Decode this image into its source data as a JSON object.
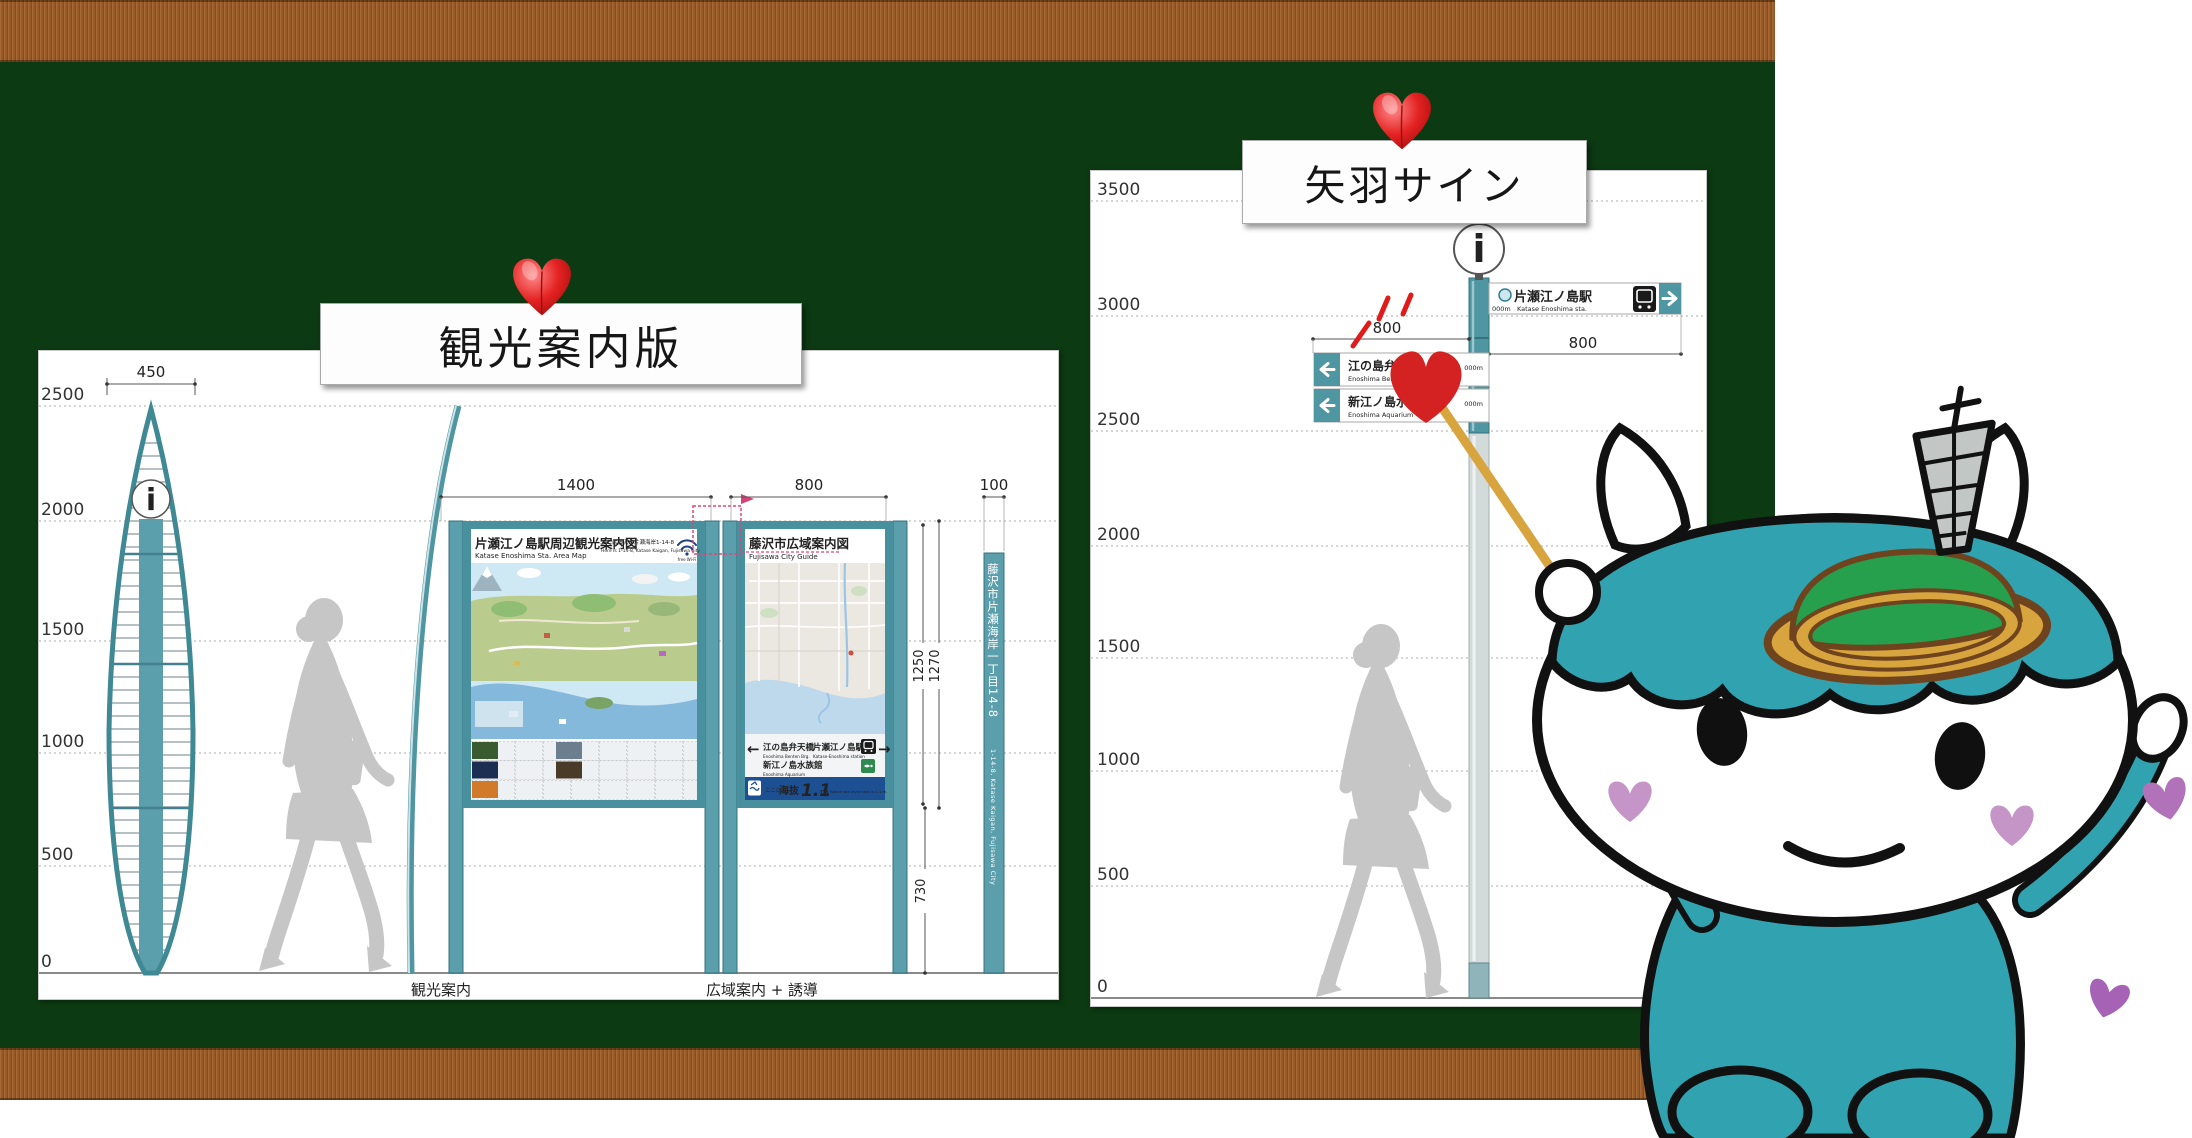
{
  "left": {
    "title": "観光案内版",
    "axis": [
      "2500",
      "2000",
      "1500",
      "1000",
      "500",
      "0"
    ],
    "dims": {
      "kiosk_w": "450",
      "main_w": "1400",
      "sub_w": "800",
      "pole_w": "100",
      "inner_h": "1250",
      "outer_h": "1270",
      "base_h": "730"
    },
    "kiosk_icon": "i",
    "main_board": {
      "title_jp": "片瀬江ノ島駅周辺観光案内図",
      "title_en": "Katase Enoshima Sta. Area Map",
      "addr_jp": "ここは藤沢市片瀬海岸1-14-8",
      "addr_en": "Here is 1-14-8, Katase Kaigan, Fujisawa City",
      "wifi": "free Wi-Fi"
    },
    "sub_board": {
      "title_jp": "藤沢市広域案内図",
      "title_en": "Fujisawa City Guide"
    },
    "guide": {
      "left_arrow": "←",
      "right_arrow": "→",
      "left_jp": "江の島弁天橋",
      "left_en": "Enoshima Benten Brg.",
      "right_jp": "片瀬江ノ島駅",
      "right_en": "Katase-Enoshima station",
      "aq_jp": "新江ノ島水族館",
      "aq_en": "Enoshima Aquarium"
    },
    "elev": {
      "here": "ここは",
      "label": "海抜",
      "value": "1.1",
      "unit": "m",
      "en": "Above sea level here is 1.1 m."
    },
    "pole_jp": "藤沢市片瀬海岸一丁目14-8",
    "pole_en": "1-14-8, Katase Kaigan, Fujisawa City",
    "foot_left": "観光案内",
    "foot_right": "広域案内 + 誘導"
  },
  "right": {
    "title": "矢羽サイン",
    "axis": [
      "3500",
      "3000",
      "2500",
      "2000",
      "1500",
      "1000",
      "500",
      "0"
    ],
    "dims": {
      "left": "800",
      "right": "800"
    },
    "icon": "i",
    "sign_station": {
      "jp": "片瀬江ノ島駅",
      "en": "Katase Enoshima sta.",
      "dist": "000m",
      "arrow": "→"
    },
    "sign_bridge": {
      "jp": "江の島弁天橋",
      "en": "Enoshima Benten Brg.",
      "dist": "000m",
      "arrow": "←"
    },
    "sign_aquarium": {
      "jp": "新江ノ島水族館",
      "en": "Enoshima Aquarium",
      "dist": "000m",
      "arrow": "←"
    }
  },
  "colors": {
    "board_green": "#0c3a12",
    "wood_brown": "#9c5a26",
    "structure_teal": "#4f96a3",
    "mascot_teal": "#31a3b0",
    "heart_red": "#d42222",
    "elevation_blue": "#1d4f93",
    "silhouette_gray": "#c6c6c6"
  }
}
